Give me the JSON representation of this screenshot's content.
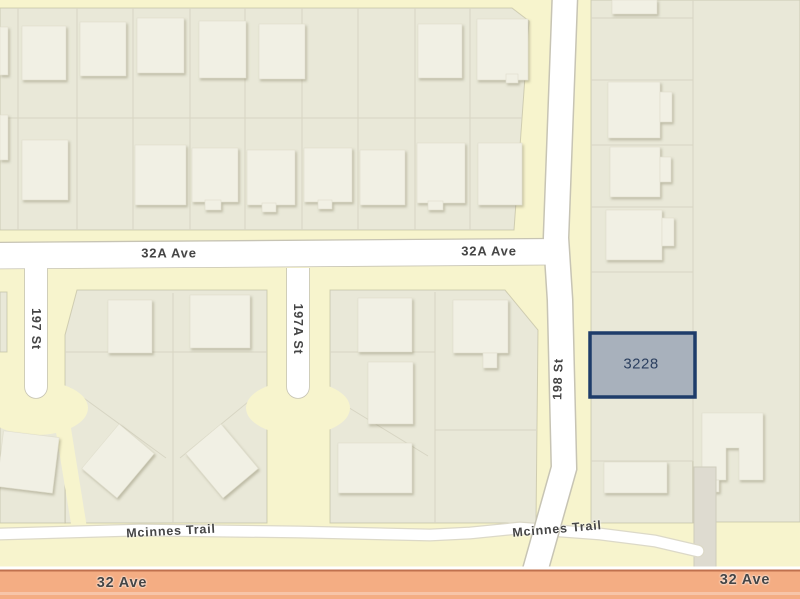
{
  "map": {
    "parcel": {
      "id": "3228"
    },
    "labels": {
      "ave32a_left": "32A Ave",
      "ave32a_right": "32A Ave",
      "st197": "197 St",
      "st197a": "197A St",
      "st198": "198 St",
      "mcinnes_left": "Mcinnes Trail",
      "mcinnes_right": "Mcinnes Trail",
      "ave32_left": "32 Ave",
      "ave32_right": "32 Ave"
    },
    "colors": {
      "background": "#f7f4cd",
      "lot": "#e9e8d8",
      "lot_line": "#d7d5c3",
      "building": "#f1f0e4",
      "road": "#ffffff",
      "road_casing": "#c7c4b4",
      "arterial": "#f4ad83",
      "arterial_casing": "#c0714e",
      "highlight_fill": "#a8b1bc",
      "highlight_border": "#1e3c6a",
      "label_text": "#454545",
      "parcel_text": "#2c4060"
    }
  }
}
